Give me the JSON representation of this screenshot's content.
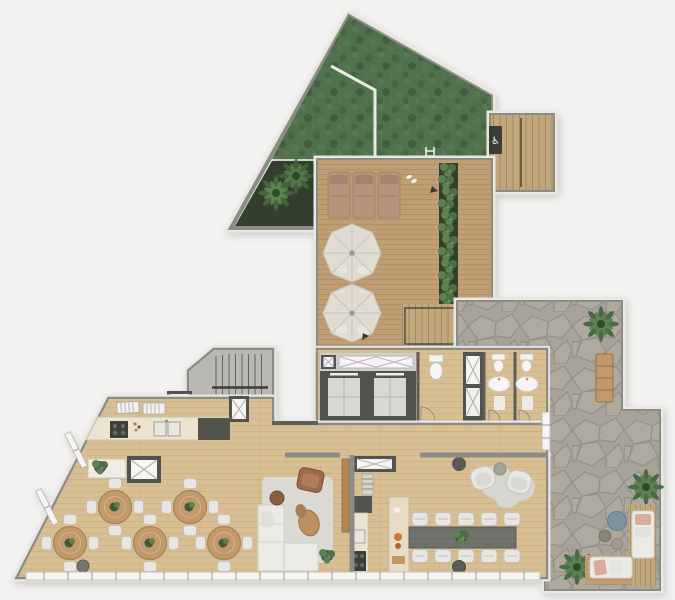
{
  "meta": {
    "type": "architectural floor plan render",
    "view": "top-down",
    "width_px": 675,
    "height_px": 600
  },
  "icons": {
    "accessible": "♿"
  },
  "colors": {
    "background": "#f3f2f0",
    "trim": "#e9e7e2",
    "wall": "#8c8c87",
    "wallDark": "#5f5f59",
    "poolBase": "#50704e",
    "deckWood": "#c09e73",
    "deckLine": "#a8865c",
    "floorWood": "#d8bf93",
    "floorLine": "#c6aa7e",
    "stairFloor": "#b8b7b3",
    "stone": "#a7a39a",
    "stoneLine": "#8e8a81",
    "planterSoil": "#333f2d",
    "plantDark": "#3e5a39",
    "plantLight": "#5d8150",
    "rug": "#dbd9d4",
    "sofa": "#eceae4",
    "chair": "#e7e6e2",
    "tanWood": "#c2996c",
    "counter": "#ece3d1",
    "dark": "#53534e",
    "longTable": "#6e706b",
    "leather": "#9a6a4c",
    "pink": "#d9aaa2",
    "blue": "#7d93a2",
    "white": "#f6f5f3",
    "lounger": "#b6947c"
  },
  "zones": [
    {
      "id": "green-roof-pool",
      "label": "green roof / pool"
    },
    {
      "id": "palm-planter",
      "label": "palm planter"
    },
    {
      "id": "sun-deck",
      "label": "sun deck"
    },
    {
      "id": "exterior-stair",
      "label": "exterior stair + accessible lift"
    },
    {
      "id": "stone-patio",
      "label": "stone patio"
    },
    {
      "id": "stair-core",
      "label": "staircase core"
    },
    {
      "id": "elevator-core",
      "label": "elevator core"
    },
    {
      "id": "washrooms",
      "label": "washrooms"
    },
    {
      "id": "cafe-dining",
      "label": "cafe dining area"
    },
    {
      "id": "lounge",
      "label": "lounge"
    },
    {
      "id": "galley-kitchen",
      "label": "galley kitchen"
    },
    {
      "id": "communal-table",
      "label": "communal dining table"
    }
  ],
  "furniture": {
    "sun_loungers": 3,
    "parasol_tables": 2,
    "cafe_tables": 5,
    "cafe_chairs_per_table": 4,
    "communal_table_seats": 10,
    "elevators": 2,
    "washbasins": 2,
    "outdoor_sofas": 2
  }
}
